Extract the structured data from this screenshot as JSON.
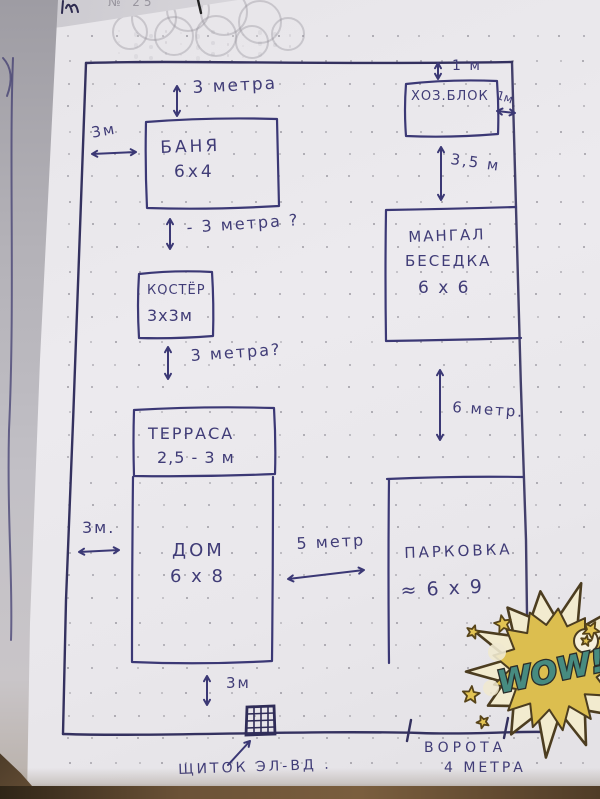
{
  "page": {
    "top_note": "№ 25",
    "sticker": {
      "wow_text": "WOW!"
    }
  },
  "plan": {
    "areas": {
      "banya": {
        "name": "БАНЯ",
        "size": "6х4"
      },
      "hozblok": {
        "name": "ХОЗ.БЛОК"
      },
      "mangal": {
        "name": "МАНГАЛ",
        "name2": "БЕСЕДКА",
        "size": "6 х 6"
      },
      "kostyor": {
        "name": "КОСТЁР",
        "size": "3х3м"
      },
      "terrasa": {
        "name": "ТЕРРАСА",
        "size": "2,5 - 3 м"
      },
      "dom": {
        "name": "ДОМ",
        "size": "6 х 8"
      },
      "parkovka": {
        "name": "ПАРКОВКА",
        "size": "≈ 6 х 9"
      }
    },
    "dimensions": {
      "top_gap": "3 метра",
      "banya_left_gap": "3м",
      "hoz_top": "1 м",
      "hoz_right": "1м",
      "hoz_mangal_gap": "3,5 м",
      "banya_kostyor_gap": "- 3 метра ?",
      "kostyor_terrasa_gap": "3 метра?",
      "mangal_parking_gap": "6 метр.",
      "dom_left_gap": "3м.",
      "dom_parking_gap": "5 метр",
      "bottom_gap": "3м"
    },
    "annotations": {
      "shchitok": "ЩИТОК ЭЛ-ВД .",
      "vorota_line1": "ВОРОТА",
      "vorota_line2": "4 МЕТРА"
    }
  }
}
